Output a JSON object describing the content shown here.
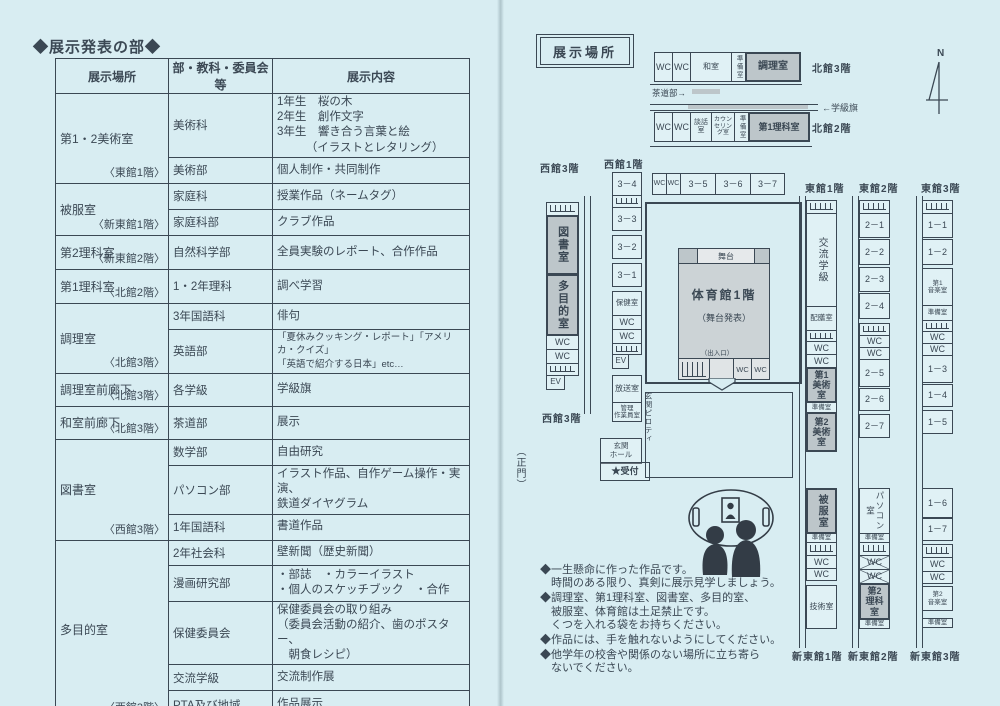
{
  "page": {
    "title": "◆展示発表の部◆"
  },
  "table": {
    "headers": [
      "展示場所",
      "部・教科・委員会等",
      "展示内容"
    ],
    "groups": [
      {
        "location": "第1・2美術室",
        "floor": "〈東館1階〉",
        "rows": [
          {
            "org": "美術科",
            "content": "1年生　桜の木\n2年生　創作文字\n3年生　響き合う言葉と絵\n　　　（イラストとレタリング）"
          },
          {
            "org": "美術部",
            "content": "個人制作・共同制作"
          }
        ]
      },
      {
        "location": "被服室",
        "floor": "〈新東館1階〉",
        "rows": [
          {
            "org": "家庭科",
            "content": "授業作品（ネームタグ）"
          },
          {
            "org": "家庭科部",
            "content": "クラブ作品"
          }
        ]
      },
      {
        "location": "第2理科室",
        "floor": "〈新東館2階〉",
        "rows": [
          {
            "org": "自然科学部",
            "content": "全員実験のレポート、合作作品"
          }
        ]
      },
      {
        "location": "第1理科室",
        "floor": "〈北館2階〉",
        "rows": [
          {
            "org": "1・2年理科",
            "content": "調べ学習"
          }
        ]
      },
      {
        "location": "調理室",
        "floor": "〈北館3階〉",
        "rows": [
          {
            "org": "3年国語科",
            "content": "俳句"
          },
          {
            "org": "英語部",
            "content": "「夏休みクッキング・レポート」「アメリカ・クイズ」\n「英語で紹介する日本」etc…"
          }
        ]
      },
      {
        "location": "調理室前廊下",
        "floor": "〈北館3階〉",
        "rows": [
          {
            "org": "各学級",
            "content": "学級旗"
          }
        ]
      },
      {
        "location": "和室前廊下",
        "floor": "〈北館3階〉",
        "rows": [
          {
            "org": "茶道部",
            "content": "展示"
          }
        ]
      },
      {
        "location": "図書室",
        "floor": "〈西館3階〉",
        "rows": [
          {
            "org": "数学部",
            "content": "自由研究"
          },
          {
            "org": "パソコン部",
            "content": "イラスト作品、自作ゲーム操作・実演、\n鉄道ダイヤグラム"
          },
          {
            "org": "1年国語科",
            "content": "書道作品"
          }
        ]
      },
      {
        "location": "多目的室",
        "floor": "〈西館3階〉",
        "rows": [
          {
            "org": "2年社会科",
            "content": "壁新聞（歴史新聞）"
          },
          {
            "org": "漫画研究部",
            "content": "・部誌　・カラーイラスト\n・個人のスケッチブック　・合作"
          },
          {
            "org": "保健委員会",
            "content": "保健委員会の取り組み\n（委員会活動の紹介、歯のポスター、\n　朝食レシピ）"
          },
          {
            "org": "交流学級",
            "content": "交流制作展"
          },
          {
            "org": "PTA及び地域",
            "content": "作品展示"
          }
        ]
      }
    ]
  },
  "map": {
    "legend_title": "展示場所",
    "compass_label": "N",
    "sado_note": "茶道部→",
    "flag_note": "←学級旗",
    "main_gate": "（正門）",
    "entrance_hall": "玄関\nホール",
    "reception": "★受付",
    "piloti": "玄関ピロティ",
    "north3": {
      "label": "北館3階",
      "segments": [
        {
          "t": "wc",
          "label": "WC",
          "w": 19
        },
        {
          "t": "wc",
          "label": "WC",
          "w": 19
        },
        {
          "t": "room",
          "label": "和室",
          "w": 42,
          "fs": 8
        },
        {
          "t": "room",
          "label": "準備室",
          "w": 15,
          "vert": true,
          "fs": 6.5
        },
        {
          "t": "hroom",
          "label": "調理室",
          "w": 56,
          "fs": 10
        }
      ]
    },
    "north2": {
      "label": "北館2階",
      "segments": [
        {
          "t": "wc",
          "label": "WC",
          "w": 19
        },
        {
          "t": "wc",
          "label": "WC",
          "w": 19
        },
        {
          "t": "room",
          "label": "談話\n室",
          "w": 22,
          "fs": 7
        },
        {
          "t": "room",
          "label": "カウン\nセリン\nグ室",
          "w": 24,
          "fs": 6
        },
        {
          "t": "room",
          "label": "準備室",
          "w": 15,
          "vert": true,
          "fs": 6.5
        },
        {
          "t": "hroom",
          "label": "第1理科室",
          "w": 62,
          "fs": 9
        }
      ]
    },
    "class_strip": {
      "segments": [
        {
          "t": "wc",
          "label": "WC",
          "w": 15,
          "fs": 7
        },
        {
          "t": "wc",
          "label": "WC",
          "w": 15,
          "fs": 7
        },
        {
          "t": "room",
          "label": "3－5",
          "w": 36
        },
        {
          "t": "room",
          "label": "3－6",
          "w": 36
        },
        {
          "t": "room",
          "label": "3－7",
          "w": 35
        }
      ]
    },
    "west3": {
      "top_label": "西館3階",
      "bottom_label": "西館3階",
      "segments": [
        {
          "t": "stairs",
          "h": 14
        },
        {
          "t": "hroom",
          "label": "図書室",
          "h": 60,
          "vert": true,
          "fs": 11
        },
        {
          "t": "hroom",
          "label": "多目的室",
          "h": 62,
          "vert": true,
          "fs": 11
        },
        {
          "t": "wc",
          "label": "WC",
          "h": 15
        },
        {
          "t": "wc",
          "label": "WC",
          "h": 15
        },
        {
          "t": "stairs",
          "h": 13
        },
        {
          "t": "ev",
          "label": "EV",
          "h": 15,
          "fs": 8
        }
      ]
    },
    "west1": {
      "label": "西館1階",
      "segments": [
        {
          "t": "room",
          "label": "3－4",
          "h": 24
        },
        {
          "t": "stairs",
          "h": 13
        },
        {
          "t": "room",
          "label": "3－3",
          "h": 24
        },
        {
          "t": "gap",
          "h": 6
        },
        {
          "t": "room",
          "label": "3－2",
          "h": 24
        },
        {
          "t": "gap",
          "h": 6
        },
        {
          "t": "room",
          "label": "3－1",
          "h": 24
        },
        {
          "t": "gap",
          "h": 6
        },
        {
          "t": "room",
          "label": "保健室",
          "h": 25,
          "fs": 7.5
        },
        {
          "t": "wc",
          "label": "WC",
          "h": 15
        },
        {
          "t": "wc",
          "label": "WC",
          "h": 15
        },
        {
          "t": "stairs",
          "h": 12
        },
        {
          "t": "ev",
          "label": "EV",
          "h": 15,
          "fs": 8
        },
        {
          "t": "gap",
          "h": 8
        },
        {
          "t": "room",
          "label": "放送室",
          "h": 28,
          "fs": 8
        },
        {
          "t": "room",
          "label": "管理\n作業員室",
          "h": 20,
          "fs": 6.5
        }
      ]
    },
    "gym": {
      "stage": "舞台",
      "name": "体育館1階",
      "sub": "（舞台発表）",
      "exit": "（出入口）",
      "wc1": "WC",
      "wc2": "WC"
    },
    "east_columns": [
      {
        "top_label": "東館1階",
        "bottom_label": "新東館1階",
        "top_segments": [
          {
            "t": "stairs",
            "h": 14
          },
          {
            "t": "room",
            "label": "交流学級",
            "h": 94,
            "vert": true,
            "fs": 10
          },
          {
            "t": "room",
            "label": "配膳室",
            "h": 25,
            "fs": 7.5
          },
          {
            "t": "stairs",
            "h": 12
          },
          {
            "t": "wc",
            "label": "WC",
            "h": 14
          },
          {
            "t": "wc",
            "label": "WC",
            "h": 14
          },
          {
            "t": "hroom",
            "label": "第1\n美術\n室",
            "h": 36,
            "fs": 9
          },
          {
            "t": "room",
            "label": "準備室",
            "h": 11,
            "fs": 6.5
          },
          {
            "t": "hroom",
            "label": "第2\n美術\n室",
            "h": 40,
            "fs": 9
          }
        ],
        "bottom_segments": [
          {
            "t": "hroom",
            "label": "被服室",
            "h": 46,
            "vert": true,
            "fs": 10
          },
          {
            "t": "room",
            "label": "準備室",
            "h": 10,
            "fs": 6.5
          },
          {
            "t": "stairs",
            "h": 14
          },
          {
            "t": "wc",
            "label": "WC",
            "h": 14
          },
          {
            "t": "wc",
            "label": "WC",
            "h": 13
          },
          {
            "t": "gap",
            "h": 6
          },
          {
            "t": "room",
            "label": "技術室",
            "h": 44,
            "fs": 8
          }
        ]
      },
      {
        "top_label": "東館2階",
        "bottom_label": "新東館2階",
        "top_segments": [
          {
            "t": "stairs",
            "h": 14
          },
          {
            "t": "room",
            "label": "2－1",
            "h": 25
          },
          {
            "t": "gap",
            "h": 3
          },
          {
            "t": "room",
            "label": "2－2",
            "h": 26
          },
          {
            "t": "gap",
            "h": 4
          },
          {
            "t": "room",
            "label": "2－3",
            "h": 25
          },
          {
            "t": "gap",
            "h": 3
          },
          {
            "t": "room",
            "label": "2－4",
            "h": 26
          },
          {
            "t": "gap",
            "h": 6
          },
          {
            "t": "stairs",
            "h": 13
          },
          {
            "t": "wc",
            "label": "WC",
            "h": 13
          },
          {
            "t": "wc",
            "label": "WC",
            "h": 13
          },
          {
            "t": "room",
            "label": "2－5",
            "h": 28
          },
          {
            "t": "gap",
            "h": 3
          },
          {
            "t": "room",
            "label": "2－6",
            "h": 23
          },
          {
            "t": "gap",
            "h": 5
          },
          {
            "t": "room",
            "label": "2－7",
            "h": 24
          }
        ],
        "bottom_segments": [
          {
            "t": "room",
            "label": "パソコン室",
            "h": 46,
            "vert": true,
            "fs": 8.5
          },
          {
            "t": "room",
            "label": "準備室",
            "h": 10,
            "fs": 6.5
          },
          {
            "t": "stairs",
            "h": 14
          },
          {
            "t": "wcx",
            "label": "WC",
            "h": 15
          },
          {
            "t": "wcx",
            "label": "WC",
            "h": 15
          },
          {
            "t": "hroom",
            "label": "第2\n理科\n室",
            "h": 37,
            "fs": 9
          },
          {
            "t": "room",
            "label": "準備室",
            "h": 10,
            "fs": 6.5
          }
        ]
      },
      {
        "top_label": "東館3階",
        "bottom_label": "新東館3階",
        "top_segments": [
          {
            "t": "stairs",
            "h": 14
          },
          {
            "t": "room",
            "label": "1－1",
            "h": 25
          },
          {
            "t": "gap",
            "h": 3
          },
          {
            "t": "room",
            "label": "1－2",
            "h": 26
          },
          {
            "t": "gap",
            "h": 5
          },
          {
            "t": "room",
            "label": "第1\n音楽室",
            "h": 38,
            "fs": 6.5
          },
          {
            "t": "room",
            "label": "準備室",
            "h": 16,
            "fs": 6.5
          },
          {
            "t": "stairs",
            "h": 12
          },
          {
            "t": "wc",
            "label": "WC",
            "h": 13
          },
          {
            "t": "wc",
            "label": "WC",
            "h": 13
          },
          {
            "t": "room",
            "label": "1－3",
            "h": 28
          },
          {
            "t": "gap",
            "h": 3
          },
          {
            "t": "room",
            "label": "1－4",
            "h": 23
          },
          {
            "t": "gap",
            "h": 5
          },
          {
            "t": "room",
            "label": "1－5",
            "h": 24
          }
        ],
        "bottom_segments": [
          {
            "t": "room",
            "label": "1－6",
            "h": 30
          },
          {
            "t": "gap",
            "h": 2
          },
          {
            "t": "room",
            "label": "1－7",
            "h": 23
          },
          {
            "t": "gap",
            "h": 5
          },
          {
            "t": "stairs",
            "h": 14
          },
          {
            "t": "wc",
            "label": "WC",
            "h": 15
          },
          {
            "t": "wc",
            "label": "WC",
            "h": 13
          },
          {
            "t": "gap",
            "h": 4
          },
          {
            "t": "room",
            "label": "第2\n音楽室",
            "h": 25,
            "fs": 6.5
          },
          {
            "t": "gap",
            "h": 9
          },
          {
            "t": "room",
            "label": "準備室",
            "h": 10,
            "fs": 6.5
          }
        ]
      }
    ]
  },
  "notes": [
    "◆一生懸命に作った作品です。\n　時間のある限り、真剣に展示見学しましょう。",
    "◆調理室、第1理科室、図書室、多目的室、\n　被服室、体育館は土足禁止です。\n　くつを入れる袋をお持ちください。",
    "◆作品には、手を触れないようにしてください。",
    "◆他学年の校舎や関係のない場所に立ち寄ら\n　ないでください。"
  ]
}
